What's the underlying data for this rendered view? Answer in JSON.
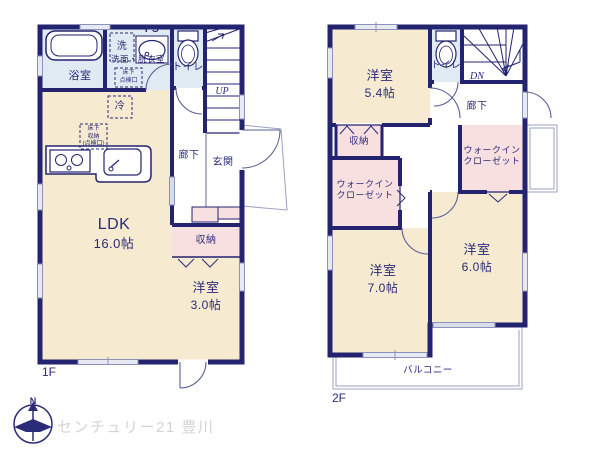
{
  "branding": {
    "watermark": "センチュリー21 豊川",
    "compass_north": "N"
  },
  "colors": {
    "wall": "#232370",
    "text": "#2b2b78",
    "room_cream": "#f6ead0",
    "wet_blue": "#dfeaf2",
    "storage_pink": "#f8e0e1",
    "window_gray": "#e7eaf3",
    "watermark_gray": "#d4d4d4"
  },
  "floor1": {
    "label": "1F",
    "rooms": {
      "bath": "浴室",
      "washroom": "洗面・脱衣室",
      "washer": "洗",
      "pipe_space": "PS",
      "underfloor_access": "床下\n点検口",
      "toilet": "トイレ",
      "stairs_up": "UP",
      "fridge": "冷",
      "underfloor_storage": "床下\n収納\n(点検口)",
      "hallway": "廊下",
      "entrance": "玄関",
      "ldk_name": "LDK",
      "ldk_size": "16.0帖",
      "storage": "収納",
      "bedroom3_name": "洋室",
      "bedroom3_size": "3.0帖"
    }
  },
  "floor2": {
    "label": "2F",
    "rooms": {
      "bedroom54_name": "洋室",
      "bedroom54_size": "5.4帖",
      "toilet": "トイレ",
      "stairs_down": "DN",
      "hallway": "廊下",
      "storage": "収納",
      "wic_left": "ウォークイン\nクローゼット",
      "wic_right": "ウォークイン\nクローゼット",
      "bedroom70_name": "洋室",
      "bedroom70_size": "7.0帖",
      "bedroom60_name": "洋室",
      "bedroom60_size": "6.0帖",
      "balcony": "バルコニー"
    }
  }
}
